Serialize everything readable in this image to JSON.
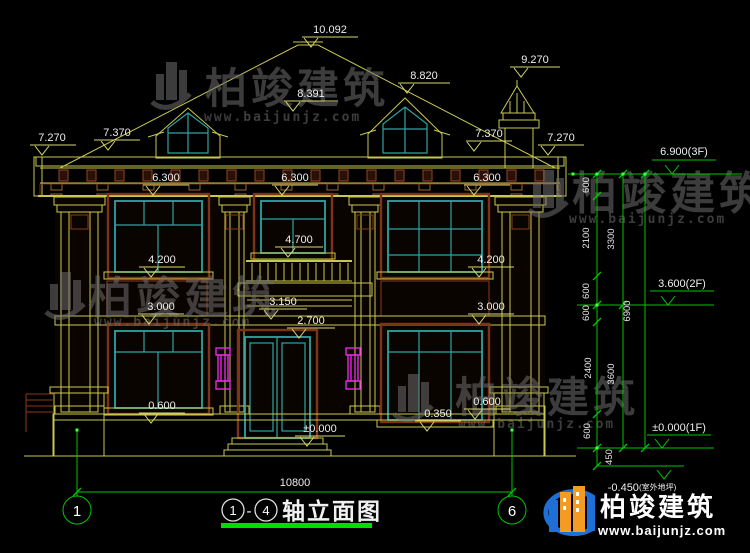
{
  "elevation_marks": {
    "ridge": "10.092",
    "chimney_top": "9.270",
    "dormer_right": "8.820",
    "dormer_left": "8.391",
    "eave_upper_left": "7.370",
    "eave_upper_right": "7.370",
    "eave_left": "7.270",
    "eave_right": "7.270",
    "window_head_left": "6.300",
    "window_head_center": "6.300",
    "window_head_right": "6.300",
    "center_sill_2f": "4.700",
    "left_sill_2f": "4.200",
    "right_sill_2f": "4.200",
    "balcony": "3.150",
    "panel_left": "3.000",
    "panel_right": "3.000",
    "door_head": "2.700",
    "left_sill_1f": "0.600",
    "right_sill_low": "0.350",
    "right_sill_1f": "0.600",
    "floor": "±0.000"
  },
  "floor_levels": {
    "third": "6.900(3F)",
    "second": "3.600(2F)",
    "first": "±0.000(1F)",
    "outdoor": "-0.450",
    "outdoor_note": "(室外地坪)"
  },
  "vertical_dims": {
    "v600_eave": "600",
    "v2100": "2100",
    "v600_sill": "600",
    "v600_floor2": "600",
    "v2400": "2400",
    "v600_base": "600",
    "v450": "450",
    "v3300": "3300",
    "v3600": "3600",
    "v6900": "6900"
  },
  "horizontal_dims": {
    "total_width": "10800"
  },
  "axis_bubbles": {
    "left": "1",
    "right": "6"
  },
  "title_block": {
    "from": "1",
    "sep": "-",
    "to": "4",
    "name": "轴立面图"
  },
  "watermark": {
    "brand": "柏竣建筑",
    "url": "www.baijunjz.com"
  },
  "footer_logo": {
    "brand": "柏竣建筑",
    "url": "www.baijunjz.com"
  }
}
